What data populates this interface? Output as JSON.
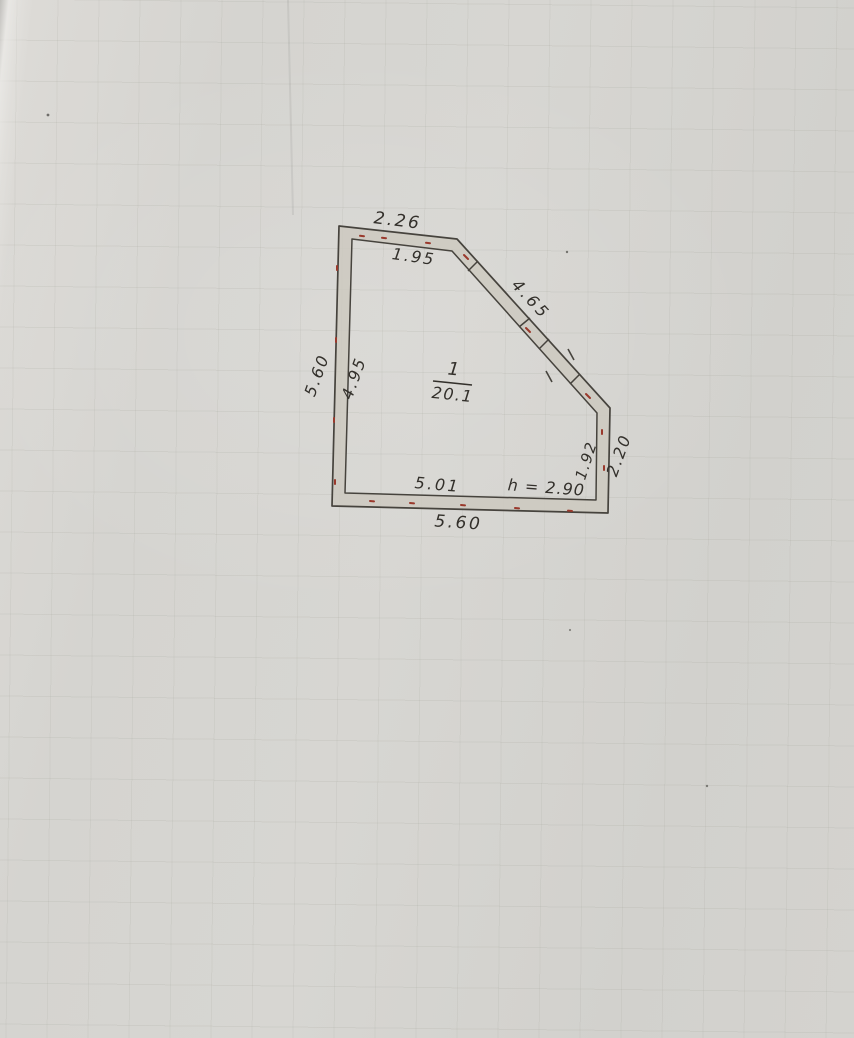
{
  "floor_plan": {
    "room": {
      "number": "1",
      "area": "20.1",
      "height_note": "h = 2.90"
    },
    "dimensions": {
      "top_outer": "2.26",
      "top_inner": "1.95",
      "left_outer": "5.60",
      "left_inner": "4.95",
      "diagonal": "4.65",
      "right_inner": "1.92",
      "right_outer": "2.20",
      "bottom_inner": "5.01",
      "bottom_outer": "5.60"
    },
    "colors": {
      "ink": "#33302b",
      "blue_ink": "#3a5aa8",
      "red_tick": "#9a392c",
      "paper": "#d5d4d0",
      "wall_fill": "#cdc9bf"
    }
  }
}
